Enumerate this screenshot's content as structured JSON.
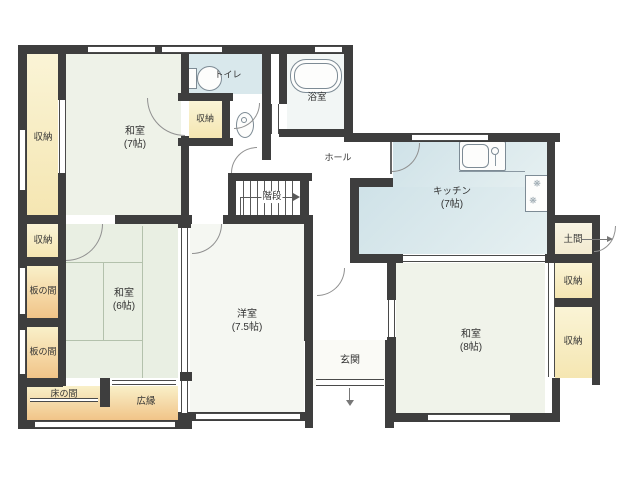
{
  "floorplan": {
    "labels": {
      "washitsu7": {
        "name": "和室",
        "size": "(7帖)"
      },
      "washitsu6": {
        "name": "和室",
        "size": "(6帖)"
      },
      "washitsu8": {
        "name": "和室",
        "size": "(8帖)"
      },
      "youshitsu": {
        "name": "洋室",
        "size": "(7.5帖)"
      },
      "kitchen": {
        "name": "キッチン",
        "size": "(7帖)"
      },
      "closet": {
        "name": "収納"
      },
      "toilet": {
        "name": "トイレ"
      },
      "bath": {
        "name": "浴室"
      },
      "hall": {
        "name": "ホール"
      },
      "stairs": {
        "name": "階段"
      },
      "genkan": {
        "name": "玄関"
      },
      "doma": {
        "name": "土間"
      },
      "itanoma": {
        "name": "板の間"
      },
      "tokonoma": {
        "name": "床の間"
      },
      "hiroen": {
        "name": "広縁"
      }
    },
    "colors": {
      "wall": "#3e3e3e",
      "tatami": "#eef2e8",
      "water_rooms": "#d9e8ec",
      "storage": "#f5e6b2",
      "wood_floor": "#f1c488"
    }
  }
}
